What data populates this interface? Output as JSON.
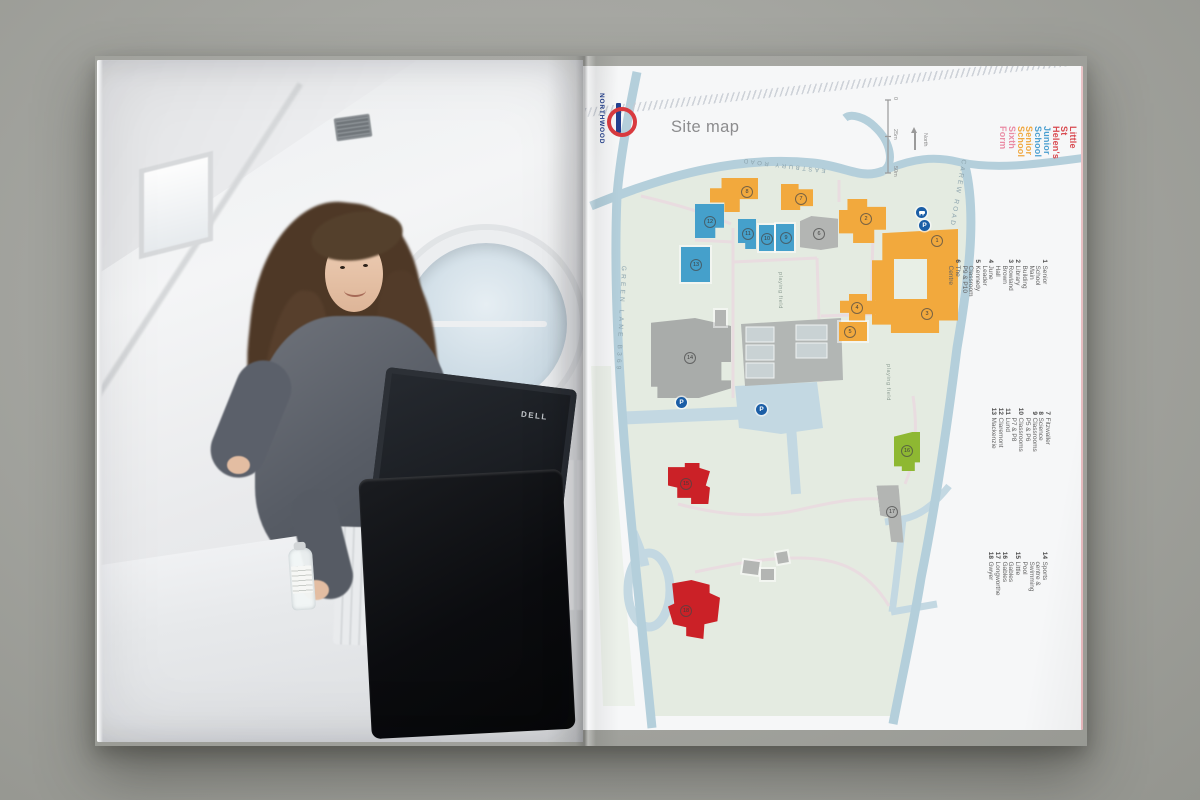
{
  "page_title": "Site map",
  "station": {
    "name": "NORTHWOOD"
  },
  "scale": {
    "t0": "0",
    "t25": "25m",
    "t50": "50m",
    "north": "North"
  },
  "legend": {
    "items": [
      {
        "label": "Little St Helen's",
        "color": "#d94a50"
      },
      {
        "label": "Junior School",
        "color": "#4a9fd0"
      },
      {
        "label": "Senior School",
        "color": "#f0a73e"
      },
      {
        "label": "Sixth Form",
        "color": "#ea8ba4"
      }
    ]
  },
  "key": {
    "col1": [
      {
        "num": "1",
        "label": "Senior School Main Building"
      },
      {
        "num": "2",
        "label": "Library"
      },
      {
        "num": "3",
        "label": "Rowland Brown Hall"
      },
      {
        "num": "4",
        "label": "June Leader"
      },
      {
        "num": "5",
        "label": "Kennedy"
      },
      {
        "num": "",
        "label": "Classroom P9 & P10"
      },
      {
        "num": "6",
        "label": "The Centre"
      }
    ],
    "col2": [
      {
        "num": "7",
        "label": "Fitzwaller"
      },
      {
        "num": "8",
        "label": "Science"
      },
      {
        "num": "9",
        "label": "Classrooms P5 & P6"
      },
      {
        "num": "10",
        "label": "Classrooms P7 & P8"
      },
      {
        "num": "11",
        "label": "Lund"
      },
      {
        "num": "12",
        "label": "Claremont"
      },
      {
        "num": "13",
        "label": "Mackenzie"
      }
    ],
    "col3": [
      {
        "num": "14",
        "label": "Sports centre & Swimming Pool"
      },
      {
        "num": "15",
        "label": "Little Gables"
      },
      {
        "num": "16",
        "label": "Gables"
      },
      {
        "num": "17",
        "label": "Longworthe"
      },
      {
        "num": "18",
        "label": "Gwyer"
      }
    ]
  },
  "roads": {
    "eastbury": "EASTBURY ROAD",
    "green_lane": "GREEN LANE B369",
    "carew": "CAREW ROAD"
  },
  "map_labels": {
    "playing_field": "playing field"
  },
  "building_markers": [
    {
      "num": "8"
    },
    {
      "num": "7"
    },
    {
      "num": "2"
    },
    {
      "num": "1"
    },
    {
      "num": "3"
    },
    {
      "num": "4"
    },
    {
      "num": "5"
    },
    {
      "num": "12"
    },
    {
      "num": "13"
    },
    {
      "num": "11"
    },
    {
      "num": "10"
    },
    {
      "num": "9"
    },
    {
      "num": "6"
    },
    {
      "num": "14"
    },
    {
      "num": "17"
    },
    {
      "num": "16"
    },
    {
      "num": "15"
    },
    {
      "num": "18"
    }
  ],
  "markers": {
    "parking": "P"
  },
  "photo": {
    "monitor_brand": "DELL"
  },
  "colors": {
    "backdrop": "#a5a6a1",
    "page": "#f6f7f8",
    "campus": "#e4ebe1",
    "road": "#b4cfdb",
    "driveway": "#c3d8e2",
    "path": "#e9dce0",
    "senior": "#f2a93d",
    "junior": "#45a0cb",
    "gray_building": "#b3b5b3",
    "green_building": "#8eb832",
    "red_building": "#cb2127",
    "marker_blue": "#1b5ea6",
    "roundel_red": "#d93a3f",
    "roundel_blue": "#23408e"
  }
}
